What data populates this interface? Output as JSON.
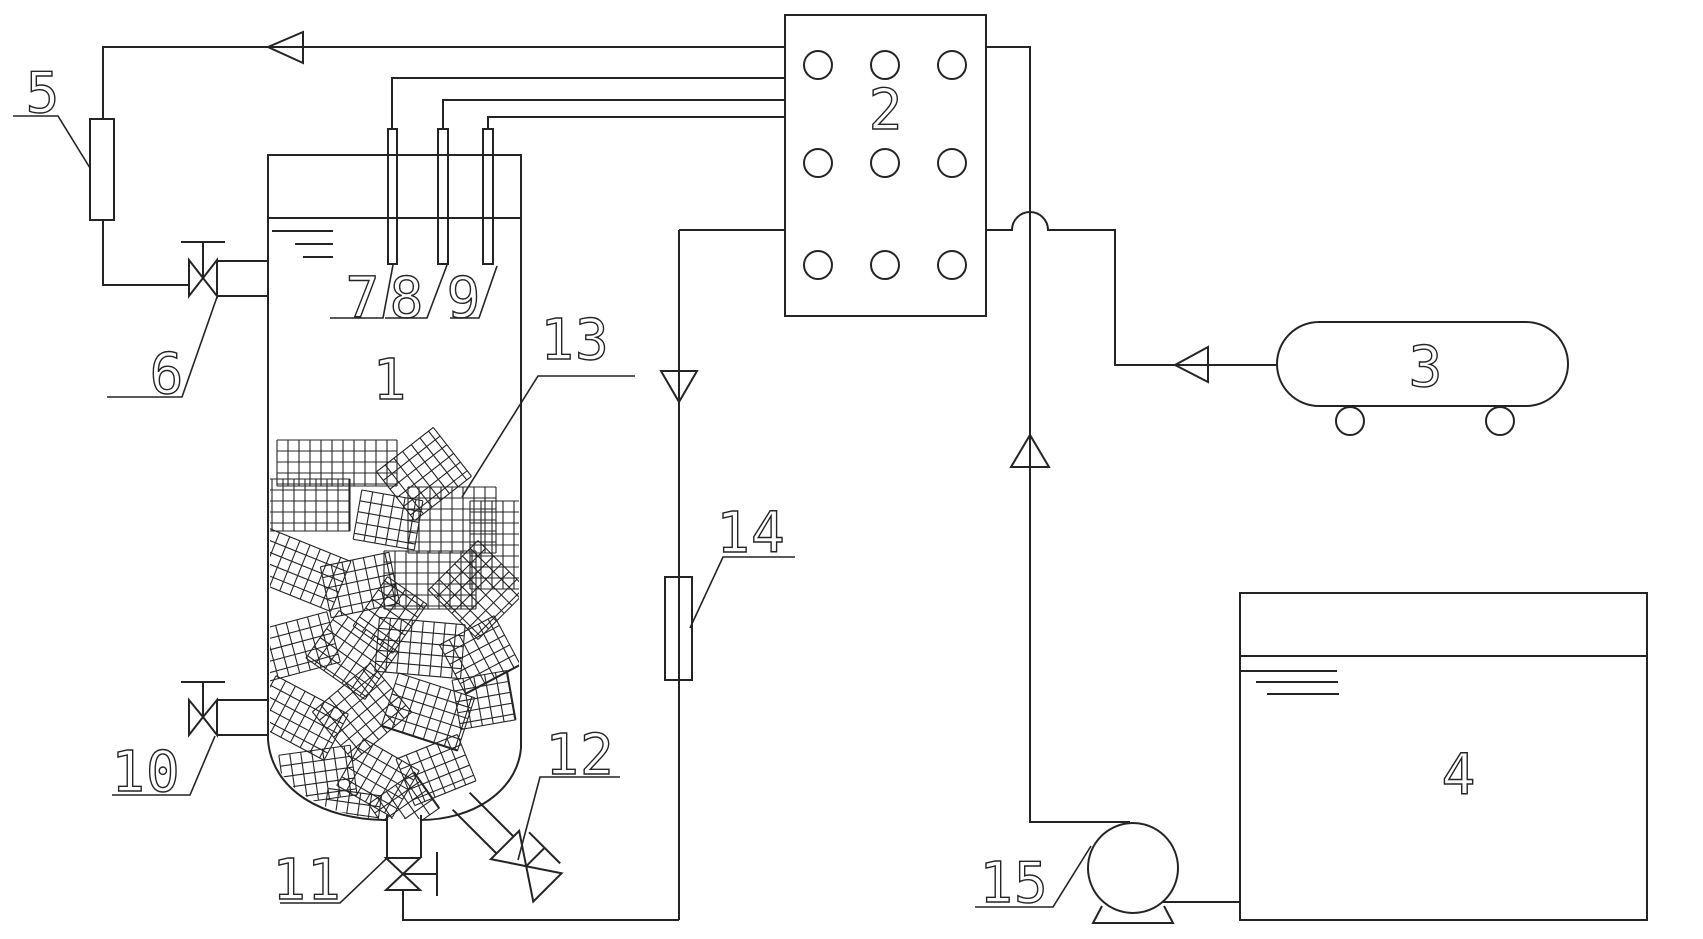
{
  "figure": {
    "type": "process-flow-schematic",
    "style": {
      "line_color": "#242424",
      "background": "#ffffff"
    },
    "labels": {
      "reactor_vessel": "1",
      "control_box": "2",
      "gas_cylinder": "3",
      "reservoir_tank": "4",
      "gas_flowmeter": "5",
      "inlet_valve": "6",
      "probe_a": "7",
      "probe_b": "8",
      "probe_c": "9",
      "sampling_valve": "10",
      "bottom_drain_valve": "11",
      "angle_drain_valve": "12",
      "packing_media": "13",
      "rotameter": "14",
      "pump": "15"
    }
  },
  "packing_tiles": [
    {
      "cx": 337,
      "cy": 463,
      "w": 120,
      "h": 46,
      "a": 0
    },
    {
      "cx": 300,
      "cy": 505,
      "w": 100,
      "h": 52,
      "a": 0
    },
    {
      "cx": 424,
      "cy": 474,
      "w": 72,
      "h": 62,
      "a": -38
    },
    {
      "cx": 388,
      "cy": 520,
      "w": 62,
      "h": 50,
      "a": 10
    },
    {
      "cx": 452,
      "cy": 520,
      "w": 88,
      "h": 66,
      "a": 0
    },
    {
      "cx": 498,
      "cy": 545,
      "w": 56,
      "h": 88,
      "a": 0
    },
    {
      "cx": 300,
      "cy": 570,
      "w": 88,
      "h": 54,
      "a": 22
    },
    {
      "cx": 360,
      "cy": 585,
      "w": 70,
      "h": 52,
      "a": -12
    },
    {
      "cx": 430,
      "cy": 580,
      "w": 92,
      "h": 58,
      "a": 0
    },
    {
      "cx": 478,
      "cy": 590,
      "w": 70,
      "h": 70,
      "a": 45
    },
    {
      "cx": 292,
      "cy": 648,
      "w": 86,
      "h": 52,
      "a": -15
    },
    {
      "cx": 352,
      "cy": 655,
      "w": 72,
      "h": 58,
      "a": 35
    },
    {
      "cx": 420,
      "cy": 648,
      "w": 86,
      "h": 54,
      "a": 5
    },
    {
      "cx": 480,
      "cy": 655,
      "w": 62,
      "h": 56,
      "a": -28
    },
    {
      "cx": 390,
      "cy": 615,
      "w": 60,
      "h": 48,
      "a": -55
    },
    {
      "cx": 300,
      "cy": 718,
      "w": 82,
      "h": 52,
      "a": 28
    },
    {
      "cx": 362,
      "cy": 712,
      "w": 76,
      "h": 64,
      "a": -40
    },
    {
      "cx": 428,
      "cy": 712,
      "w": 80,
      "h": 56,
      "a": 18
    },
    {
      "cx": 484,
      "cy": 700,
      "w": 56,
      "h": 50,
      "a": -10
    },
    {
      "cx": 318,
      "cy": 775,
      "w": 72,
      "h": 50,
      "a": -8
    },
    {
      "cx": 378,
      "cy": 778,
      "w": 64,
      "h": 54,
      "a": 30
    },
    {
      "cx": 436,
      "cy": 770,
      "w": 66,
      "h": 50,
      "a": -22
    },
    {
      "cx": 352,
      "cy": 812,
      "w": 54,
      "h": 40,
      "a": 8
    },
    {
      "cx": 404,
      "cy": 806,
      "w": 56,
      "h": 44,
      "a": -35
    }
  ]
}
